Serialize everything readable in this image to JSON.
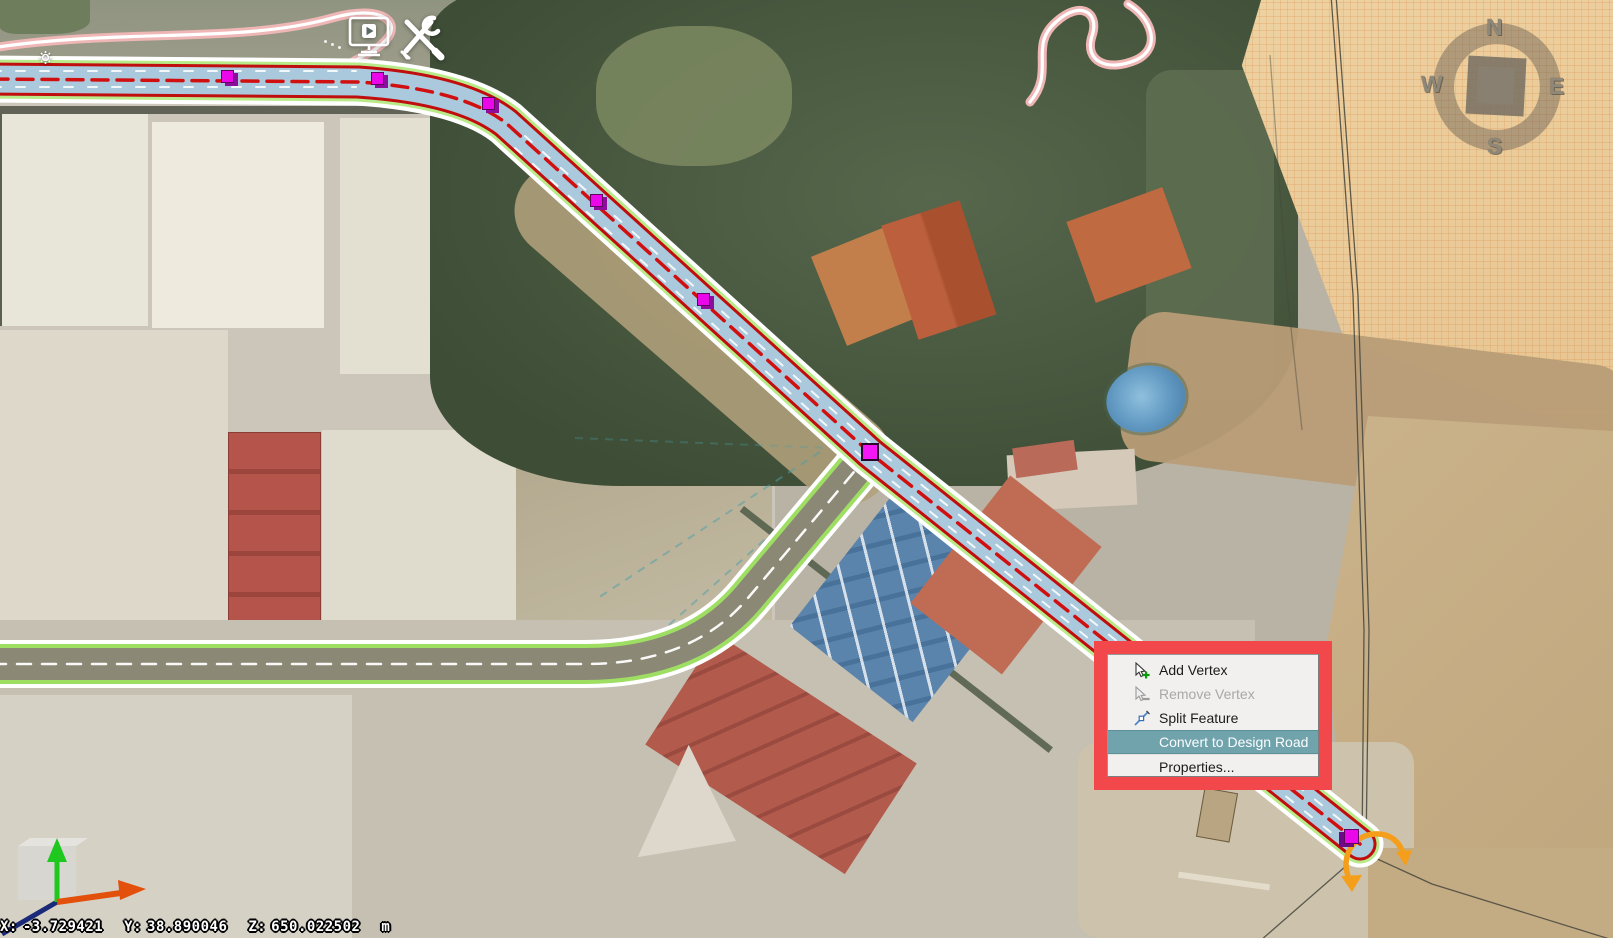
{
  "app": {
    "name": "3D road design map viewer"
  },
  "toolbar": {
    "buttons": [
      {
        "name": "home",
        "icon": "home-icon",
        "bg": "#ffffff"
      },
      {
        "name": "settings",
        "icon": "gear-icon"
      },
      {
        "name": "beam-structures",
        "icon": "i-beam-icon",
        "bg": "#e4571e",
        "glyph": "I"
      },
      {
        "name": "roads",
        "icon": "road-icon",
        "bg": "#97824a"
      },
      {
        "name": "bridges",
        "icon": "bridge-icon",
        "bg": "#5a3da0"
      },
      {
        "name": "tunnels",
        "icon": "tunnel-icon",
        "bg": "#008a90"
      },
      {
        "name": "presentation",
        "icon": "monitor-play-icon"
      },
      {
        "name": "tools",
        "icon": "tools-icon"
      }
    ]
  },
  "compass": {
    "north": "N",
    "east": "E",
    "south": "S",
    "west": "W"
  },
  "context_menu": {
    "annotation": {
      "type": "highlight-box",
      "color": "#f2484b"
    },
    "highlight_color": "#71a3ad",
    "items": [
      {
        "label": "Add Vertex",
        "state": "enabled",
        "icon": "add-vertex-icon"
      },
      {
        "label": "Remove Vertex",
        "state": "disabled",
        "icon": "remove-vertex-icon"
      },
      {
        "label": "Split Feature",
        "state": "enabled",
        "icon": "split-feature-icon"
      },
      {
        "label": "Convert to Design Road",
        "state": "highlighted",
        "icon": null
      },
      {
        "label": "Properties...",
        "state": "enabled",
        "icon": null
      }
    ]
  },
  "status_bar": {
    "x_label": "X:",
    "x_value": "-3.729421",
    "y_label": "Y:",
    "y_value": "38.890046",
    "z_label": "Z:",
    "z_value": "650.022502",
    "unit": "m"
  },
  "map": {
    "selected_road": {
      "fill": "#abc9dc",
      "edge": "#c00d0d",
      "centerline": "#d01010",
      "casing": "#ffffff",
      "outer_edge": "#b9ea8a",
      "vertex_color": "#ea08ea",
      "vertex_count": 7
    },
    "secondary_road": {
      "fill": "#8c8876",
      "edge": "#9ede62",
      "centerline": "#ffffff"
    },
    "trajectory_color": "#efb6b6",
    "end_rotation_handle_color": "#f59e1b",
    "gizmo_axes": {
      "x": "#e2500c",
      "y": "#1ec81e",
      "z": "#1a2a78"
    }
  }
}
